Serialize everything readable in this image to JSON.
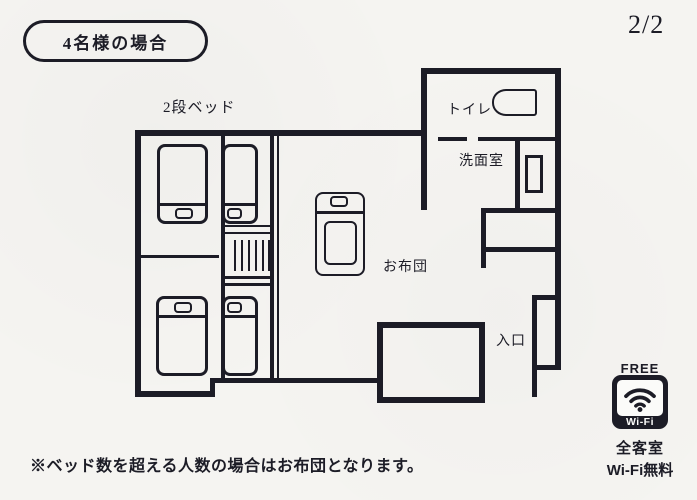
{
  "page": {
    "badge_label": "4名様の場合",
    "page_number": "2/2",
    "footnote": "※ベッド数を超える人数の場合はお布団となります。"
  },
  "floorplan": {
    "labels": {
      "bunk_bed": "2段ベッド",
      "toilet": "トイレ",
      "washroom": "洗面室",
      "futon": "お布団",
      "entrance": "入口"
    }
  },
  "wifi": {
    "free_label": "FREE",
    "badge_label": "Wi-Fi",
    "note_line1": "全客室",
    "note_line2": "Wi-Fi無料"
  },
  "colors": {
    "ink": "#1c1c26",
    "paper": "#f5f4f1",
    "white": "#fbfbf9"
  }
}
